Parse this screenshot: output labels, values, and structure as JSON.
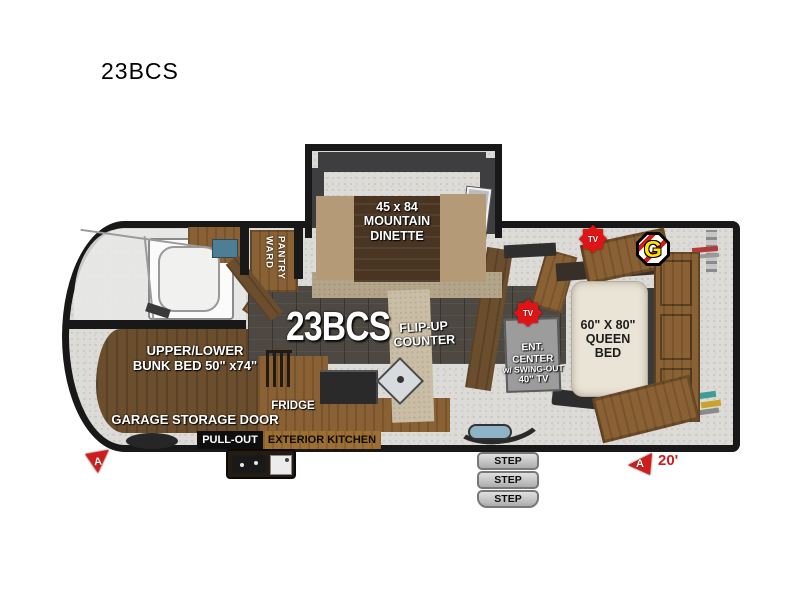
{
  "title": "23BCS",
  "colors": {
    "accent-red": "#cf1d1d",
    "tv-red": "#e01414",
    "g-yellow": "#ffe400",
    "wall-black": "#181818",
    "wood": "#8a6134",
    "wood-dark": "#6b4e2e",
    "floor-dark": "#4d4842",
    "mattress": "#eae4d6",
    "step-gray": "#c9c9c9"
  },
  "floorplan": {
    "model": "23BCS",
    "dinette": {
      "l1": "45 x 84",
      "l2": "MOUNTAIN",
      "l3": "DINETTE"
    },
    "ward": {
      "l1": "WARD",
      "l2": "PANTRY"
    },
    "flip_counter": {
      "l1": "FLIP-UP",
      "l2": "COUNTER"
    },
    "ent_center": {
      "l1": "ENT.",
      "l2": "CENTER",
      "l3": "w/ SWING-OUT",
      "l4": "40\" TV"
    },
    "queen_bed": {
      "l1": "60\" X 80\"",
      "l2": "QUEEN",
      "l3": "BED"
    },
    "bunk": {
      "l1": "UPPER/LOWER",
      "l2": "BUNK BED 50\" x74\""
    },
    "garage": "GARAGE STORAGE DOOR",
    "pull_out": "PULL-OUT",
    "exterior_kitchen": "EXTERIOR KITCHEN",
    "fridge": "FRIDGE",
    "steps": [
      "STEP",
      "STEP",
      "STEP"
    ],
    "badges": {
      "tv": "TV",
      "g": "G",
      "a": "A",
      "length": "20'"
    }
  }
}
